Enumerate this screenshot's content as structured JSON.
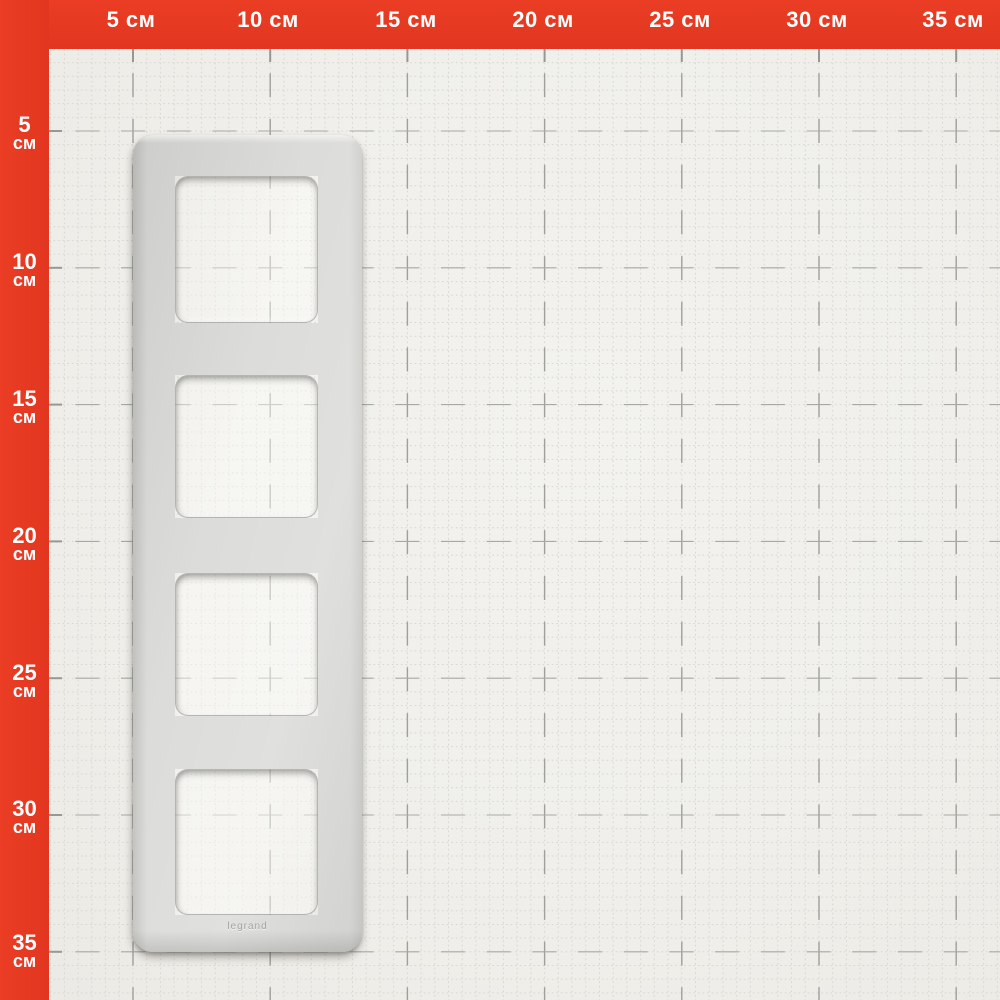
{
  "scene": {
    "description": "silver 4-gang wall plate frame lying on red-edged centimeter measurement grid",
    "openings_count": 4
  },
  "rulers": {
    "unit": "см",
    "top_labels": [
      "5 см",
      "10 см",
      "15 см",
      "20 см",
      "25 см",
      "30 см",
      "35 см"
    ],
    "left_labels": [
      {
        "value": "5",
        "unit": "см"
      },
      {
        "value": "10",
        "unit": "см"
      },
      {
        "value": "15",
        "unit": "см"
      },
      {
        "value": "20",
        "unit": "см"
      },
      {
        "value": "25",
        "unit": "см"
      },
      {
        "value": "30",
        "unit": "см"
      },
      {
        "value": "35",
        "unit": "см"
      }
    ]
  },
  "product": {
    "brand_label": "legrand"
  },
  "colors": {
    "ruler_red": "#e63b23",
    "paper": "#f0efeb",
    "grid_fine": "#d8d7d1",
    "grid_major_v": "#9fa09b",
    "grid_major_h": "#a8a9a4",
    "grid_tick": "#97988f",
    "frame_silver": "#d8d8d6",
    "label_text": "#ffffff"
  }
}
